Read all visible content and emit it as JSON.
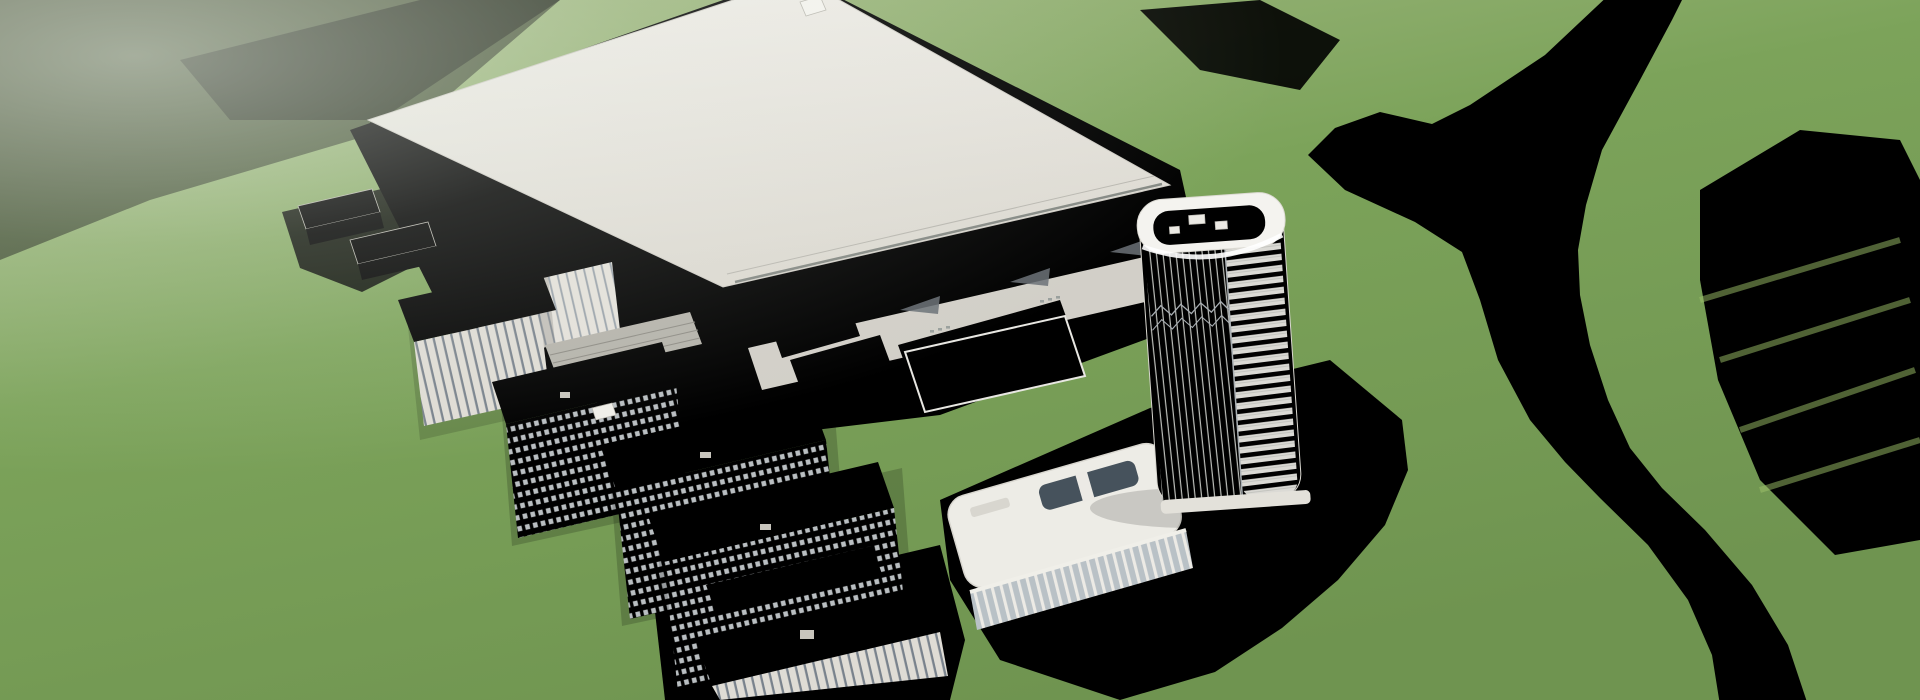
{
  "meta": {
    "type": "architectural-aerial-rendering",
    "description": "Bird's-eye 3D rendering of a large industrial campus: a huge white flat-roof factory hall, stepped annex roofs, a dark glazed hall, a white high-rise office tower with ribbed facade, a rounded low-rise headquarters, dormitory blocks with gridded windows, tree-lined boulevards, an elevated highway, parking lots full of cars with yellow-leaf trees, green meadows, dense forests and a turquoise river winding along the right side.",
    "width_px": 1920,
    "height_px": 700
  },
  "palette": {
    "grass1": "#a9bd8b",
    "grass2": "#7ca35a",
    "grass3": "#6f9450",
    "grassBright": "#8cb95e",
    "grassPale": "#bccaa4",
    "treeDark": "#3c5a33",
    "treeMid": "#4c7040",
    "treeLight": "#5f8549",
    "treeSage": "#76926a",
    "treeYellow": "#d9b84e",
    "treeYellowDark": "#b8922f",
    "roadHighway": "#7e898e",
    "roadMain": "#98a0a2",
    "roadCampus": "#b6bbb8",
    "roadEdge": "#dfe4e1",
    "laneLine": "#eef2f0",
    "water": "#2293c6",
    "waterDeep": "#15648f",
    "waterLight": "#55bddd",
    "roofLight": "#e9e7e1",
    "roofMid": "#dbd8d1",
    "roofDark": "#c9c6be",
    "apron": "#d5d7d0",
    "apronLight": "#e0e2db",
    "faceLight": "#e5e2db",
    "faceShade": "#cfccc4",
    "glassDark": "#2a323c",
    "glassFrame": "#cdd2d5",
    "glassBlue": "#4d5862",
    "towerWhite": "#f2f1ed",
    "towerDeck": "#d6d5ce",
    "towerBand": "#39424c",
    "carDark": "#252b33",
    "carWhite": "#eef0ef",
    "carRed": "#c03a2c",
    "carSilver": "#b9bfc2",
    "truckTeal": "#2e8fa8",
    "shadow": "#1e3317"
  },
  "scene": {
    "elements": [
      {
        "name": "factory-main-building",
        "label": "large white flat-roof production hall"
      },
      {
        "name": "factory-annex-roofs",
        "label": "stepped annex roofs with skylight wells"
      },
      {
        "name": "factory-glass-hall",
        "label": "dark glazed hall"
      },
      {
        "name": "rooftop-walkway",
        "label": "roof parapet walkway"
      },
      {
        "name": "office-tower",
        "label": "white high-rise tower, ribbed facade, rounded crown"
      },
      {
        "name": "hq-building",
        "label": "rounded low-rise headquarters with courtyard"
      },
      {
        "name": "dormitory-block-1",
        "label": "dormitory slab with gridded windows"
      },
      {
        "name": "dormitory-block-2",
        "label": "dormitory slab with gridded windows"
      },
      {
        "name": "dormitory-block-3",
        "label": "large dormitory slab with gridded windows"
      },
      {
        "name": "office-block-a",
        "label": "office block with vertical window stripes"
      },
      {
        "name": "office-block-b",
        "label": "office block with vertical window stripes"
      },
      {
        "name": "utility-shed",
        "label": "long low shed with slatted roof"
      },
      {
        "name": "south-office-building",
        "label": "low white office building at bottom edge"
      },
      {
        "name": "small-house-a",
        "label": "small auxiliary house"
      },
      {
        "name": "small-house-b",
        "label": "small auxiliary house"
      },
      {
        "name": "parking-lot",
        "label": "surface parking with cars and yellow trees"
      },
      {
        "name": "elevated-highway",
        "label": "elevated highway crossing top-left"
      },
      {
        "name": "west-boulevard",
        "label": "tree-lined boulevard on the west side"
      },
      {
        "name": "north-avenue",
        "label": "avenue with green median along the north-east"
      },
      {
        "name": "east-ring-road",
        "label": "ring road around the campus east side"
      },
      {
        "name": "bridge-road",
        "label": "road bridging the river to the east"
      },
      {
        "name": "river",
        "label": "turquoise river widening into a pond"
      },
      {
        "name": "meadow",
        "label": "bright green meadows"
      },
      {
        "name": "forest",
        "label": "dense tree masses"
      }
    ],
    "generation": {
      "seed": 13,
      "parking_rows": 6,
      "parking_occupancy": 0.62,
      "road_cars": 30,
      "tree_count_target": 640
    }
  }
}
